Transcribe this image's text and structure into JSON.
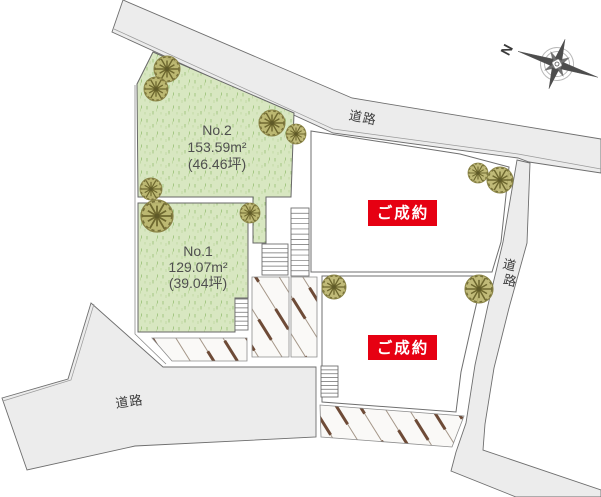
{
  "canvas": {
    "width": 601,
    "height": 497
  },
  "colors": {
    "road_fill": "#ececec",
    "plot_green": "#d8e7c1",
    "sold_red": "#e60012",
    "sold_text": "#ffffff",
    "tree_fill": "#b9b269",
    "tree_stroke": "#6e682f",
    "hatch_thin": "#9c8c7c",
    "hatch_thick": "#6e4b37",
    "label_gray": "#4f4f4f"
  },
  "plots": [
    {
      "id": "no2",
      "label": "No.2",
      "area_m2": "153.59m²",
      "area_tsubo": "(46.46坪)"
    },
    {
      "id": "no1",
      "label": "No.1",
      "area_m2": "129.07m²",
      "area_tsubo": "(39.04坪)"
    },
    {
      "id": "upper_right",
      "status": "ご成約"
    },
    {
      "id": "lower_right",
      "status": "ご成約"
    }
  ],
  "roads": {
    "top_label": "道路",
    "bottom_left_label": "道路",
    "right_label": "道路",
    "right_label_chars": [
      "道",
      "路"
    ]
  },
  "compass": {
    "north": "N"
  },
  "trees": [
    {
      "x": 167,
      "y": 69,
      "r": 13
    },
    {
      "x": 156,
      "y": 89,
      "r": 12
    },
    {
      "x": 272,
      "y": 123,
      "r": 13
    },
    {
      "x": 296,
      "y": 134,
      "r": 10
    },
    {
      "x": 151,
      "y": 189,
      "r": 11
    },
    {
      "x": 157,
      "y": 216,
      "r": 16
    },
    {
      "x": 250,
      "y": 213,
      "r": 10
    },
    {
      "x": 478,
      "y": 173,
      "r": 10
    },
    {
      "x": 500,
      "y": 180,
      "r": 13
    },
    {
      "x": 334,
      "y": 287,
      "r": 12
    },
    {
      "x": 479,
      "y": 289,
      "r": 14
    }
  ],
  "stairs": [
    {
      "x": 291,
      "y": 208,
      "w": 18,
      "h": 68,
      "steps": 13
    },
    {
      "x": 262,
      "y": 244,
      "w": 26,
      "h": 31,
      "steps": 7
    },
    {
      "x": 235,
      "y": 299,
      "w": 13,
      "h": 31,
      "steps": 7
    },
    {
      "x": 321,
      "y": 366,
      "w": 17,
      "h": 31,
      "steps": 8
    }
  ]
}
